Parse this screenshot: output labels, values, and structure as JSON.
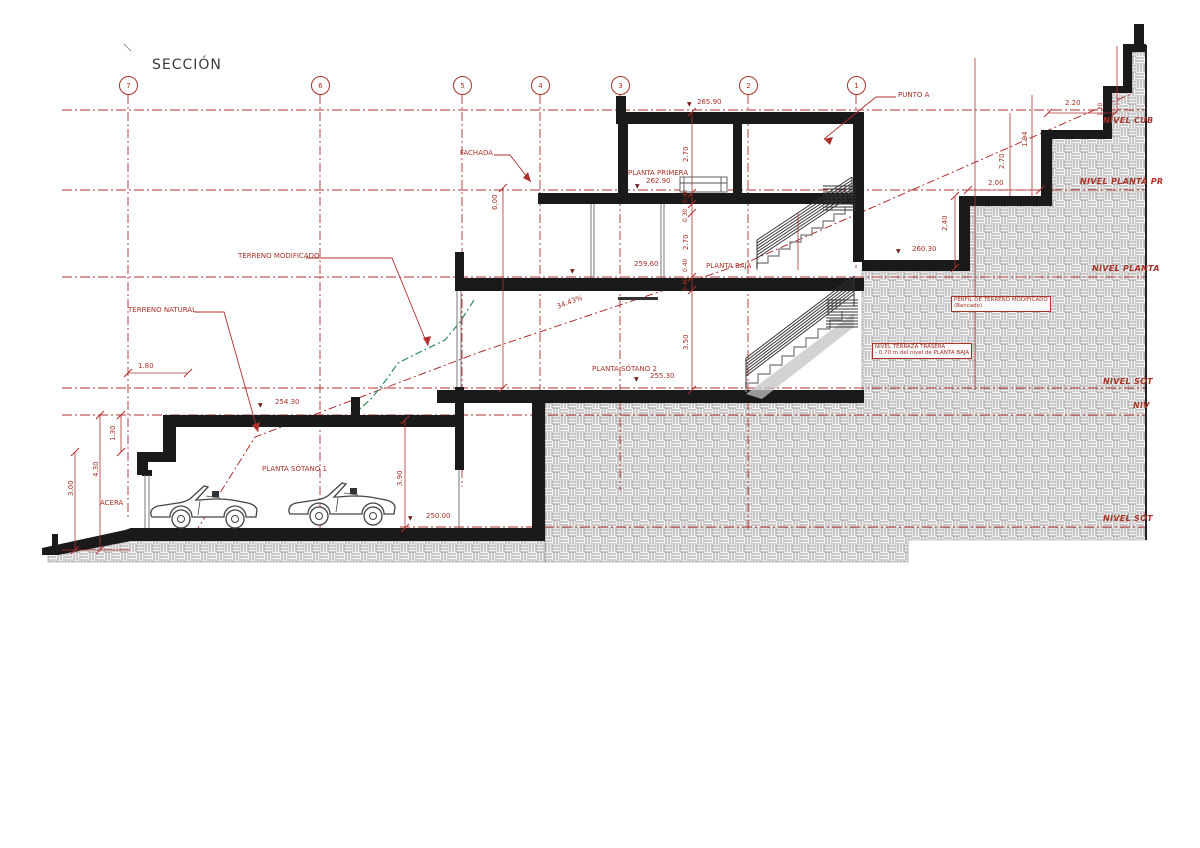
{
  "title": "SECCIÓN",
  "grid": {
    "bubbles": [
      "7",
      "6",
      "5",
      "4",
      "3",
      "2",
      "1"
    ]
  },
  "levels": {
    "cubierta": "NIVEL CUB",
    "planta_primera": "NIVEL PLANTA PR",
    "planta_baja": "NIVEL PLANTA",
    "sotano_a": "NIVEL SÓT",
    "niv": "NIV",
    "sotano_b": "NIVEL SÓT"
  },
  "elevations": {
    "cubierta": "265.90",
    "planta_primera": "262.90",
    "planta_baja": "259.60",
    "sotano2": "255.30",
    "sotano1_techo": "254.30",
    "sotano1_suelo": "250.00",
    "terraza": "260.30"
  },
  "floors": {
    "planta_primera": "PLANTA PRIMERA",
    "planta_baja": "PLANTA BAJA",
    "sotano2": "PLANTA SÓTANO 2",
    "sotano1": "PLANTA SÓTANO 1"
  },
  "annotations": {
    "fachada": "FACHADA",
    "punto_a": "PUNTO A",
    "terreno_modificado": "TERRENO MODIFICADO",
    "terreno_natural": "TERRENO NATURAL",
    "acera": "ACERA",
    "perfil_line1": "PERFIL DE TERRENO MODIFICADO",
    "perfil_line2": "(Bancado)",
    "terraza_line1": "NIVEL TERRAZA TRASERA",
    "terraza_line2": "- 0,70 m del nivel de PLANTA BAJA",
    "slope": "34.43%",
    "marker_glyph": "▼"
  },
  "dimensions": {
    "d600": "6.00",
    "d270a": "2.70",
    "d040a": "0.40",
    "d030": "0.30",
    "d270b": "2.70",
    "d040b": "0.40",
    "d040c": "0.40",
    "d350": "3.50",
    "d390": "3.90",
    "d130": "1.30",
    "d430": "4.30",
    "d300": "3.00",
    "d180": "1.80",
    "d240": "2.40",
    "d270c": "2.70",
    "d194": "1.94",
    "d110": "1.10",
    "d220": "2.20",
    "d200": "2.00"
  },
  "colors": {
    "annotation_red": "#a93226",
    "terrain_green": "#2e8b57",
    "drawing_black": "#1a1a1a",
    "hatch_gray": "#9e9e9e"
  }
}
